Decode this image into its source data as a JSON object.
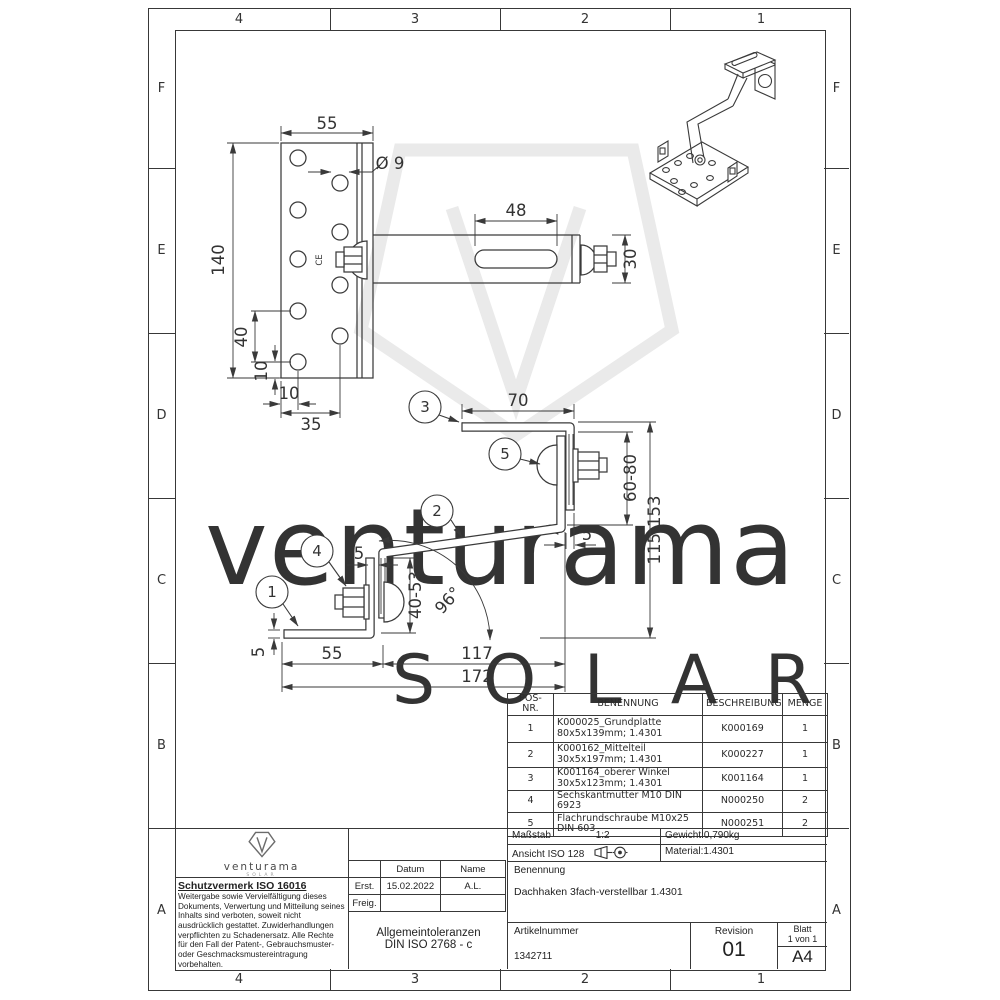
{
  "border": {
    "cols": [
      "4",
      "3",
      "2",
      "1"
    ],
    "rows": [
      "F",
      "E",
      "D",
      "C",
      "B",
      "A"
    ]
  },
  "watermark": {
    "brand": "venturama",
    "word": "SOLAR"
  },
  "views": {
    "balloons": [
      "1",
      "2",
      "3",
      "4",
      "5"
    ],
    "front": {
      "dims": {
        "w": "55",
        "h": "140",
        "dia": "Ø 9",
        "s40": "40",
        "s10v": "10",
        "s10h": "10",
        "s35": "35",
        "slot": "48",
        "bw": "30"
      },
      "stamp": "CE"
    },
    "side": {
      "dims": {
        "arm": "70",
        "gap": "60-80",
        "total_range": "115-153",
        "t5r": "5",
        "t5l": "5",
        "slot": "40-53",
        "angle": "96°",
        "base": "55",
        "mid": "117",
        "overall": "172",
        "thk": "5"
      }
    }
  },
  "parts_table": {
    "headers": [
      "POS-NR.",
      "BENENNUNG",
      "BESCHREIBUNG",
      "MENGE"
    ],
    "rows": [
      {
        "pos": "1",
        "name": "K000025_Grundplatte 80x5x139mm; 1.4301",
        "desc": "K000169",
        "qty": "1"
      },
      {
        "pos": "2",
        "name": "K000162_Mittelteil 30x5x197mm; 1.4301",
        "desc": "K000227",
        "qty": "1"
      },
      {
        "pos": "3",
        "name": "K001164_oberer Winkel 30x5x123mm; 1.4301",
        "desc": "K001164",
        "qty": "1"
      },
      {
        "pos": "4",
        "name": "Sechskantmutter M10 DIN 6923",
        "desc": "N000250",
        "qty": "2"
      },
      {
        "pos": "5",
        "name": "Flachrundschraube M10x25 DIN 603",
        "desc": "N000251",
        "qty": "2"
      }
    ]
  },
  "title_block": {
    "logo": {
      "brand": "venturama",
      "sub": "SOLAR"
    },
    "schutzvermerk": {
      "title": "Schutzvermerk ISO 16016",
      "body": "Weitergabe sowie Vervielfältigung dieses Dokuments, Verwertung und Mitteilung seines Inhalts sind verboten, soweit nicht ausdrücklich gestattet. Zuwiderhandlungen verpflichten zu Schadenersatz. Alle Rechte für den Fall der Patent-, Gebrauchsmuster- oder Geschmacksmustereintragung vorbehalten."
    },
    "approval": {
      "datum": "Datum",
      "name": "Name",
      "erst_label": "Erst.",
      "erst_datum": "15.02.2022",
      "erst_name": "A.L.",
      "freig_label": "Freig."
    },
    "tol1": "Allgemeintoleranzen",
    "tol2": "DIN ISO 2768 - c",
    "masstab_label": "Maßstab",
    "masstab": "1:2",
    "gewicht": "Gewicht:0,790kg",
    "ansicht": "Ansicht ISO 128",
    "material": "Material:1.4301",
    "benennung_label": "Benennung",
    "benennung": "Dachhaken 3fach-verstellbar 1.4301",
    "artikel_label": "Artikelnummer",
    "artikel": "1342711",
    "revision_label": "Revision",
    "revision": "01",
    "blatt_label": "Blatt",
    "blatt": "1 von 1",
    "format": "A4"
  }
}
